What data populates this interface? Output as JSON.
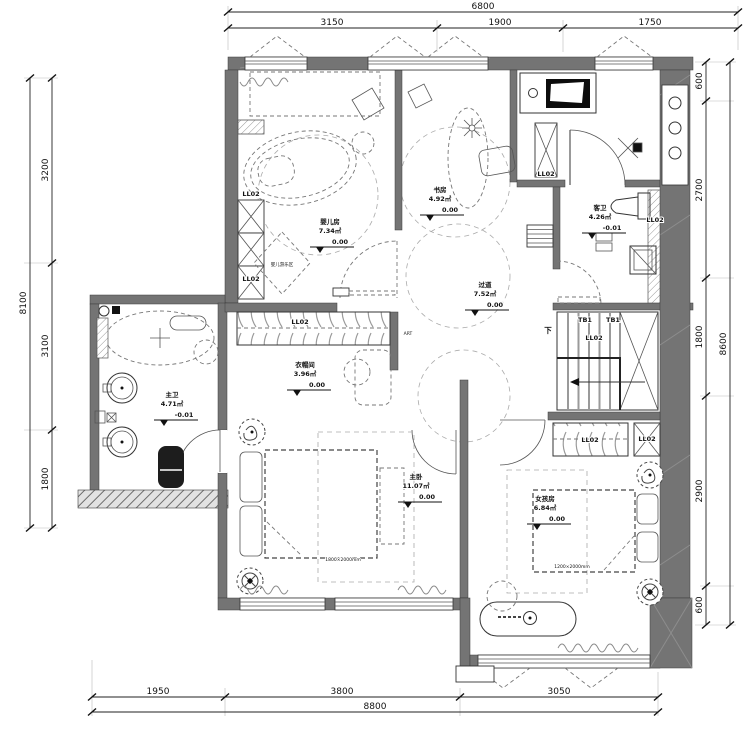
{
  "drawing": {
    "type": "residential-floor-plan"
  },
  "colors": {
    "wall": "#747474",
    "line": "#333333",
    "dash": "#999999",
    "background": "#ffffff"
  },
  "dimensions": {
    "top": {
      "total": "6800",
      "segments": [
        "3150",
        "1900",
        "1750"
      ]
    },
    "bottom": {
      "total": "8800",
      "segments": [
        "1950",
        "3800",
        "3050"
      ]
    },
    "left": {
      "total": "8100",
      "segments": [
        "3200",
        "3100",
        "1800"
      ]
    },
    "right": {
      "total": "8600",
      "segments": [
        "600",
        "2700",
        "1800",
        "2900",
        "600"
      ]
    }
  },
  "rooms": [
    {
      "id": "nursery",
      "name": "婴儿房",
      "area": "7.34㎡",
      "level": "0.00"
    },
    {
      "id": "study",
      "name": "书房",
      "area": "4.92㎡",
      "level": "0.00"
    },
    {
      "id": "guest-bath",
      "name": "客卫",
      "area": "4.26㎡",
      "level": "-0.01"
    },
    {
      "id": "corridor",
      "name": "过道",
      "area": "7.52㎡",
      "level": "0.00"
    },
    {
      "id": "cloakroom",
      "name": "衣帽间",
      "area": "3.96㎡",
      "level": "0.00"
    },
    {
      "id": "master-bath",
      "name": "主卫",
      "area": "4.71㎡",
      "level": "-0.01"
    },
    {
      "id": "master-bedroom",
      "name": "主卧",
      "area": "11.07㎡",
      "level": "0.00"
    },
    {
      "id": "girls-room",
      "name": "女孩房",
      "area": "6.84㎡",
      "level": "0.00"
    }
  ],
  "labels": {
    "ll02": "LL02",
    "tb1": "TB1",
    "down": "下",
    "art": "ART",
    "baby_play_area": "婴儿游乐区",
    "master_bed_size": "1800×2000mm",
    "girls_bed_size": "1200×2000mm"
  }
}
